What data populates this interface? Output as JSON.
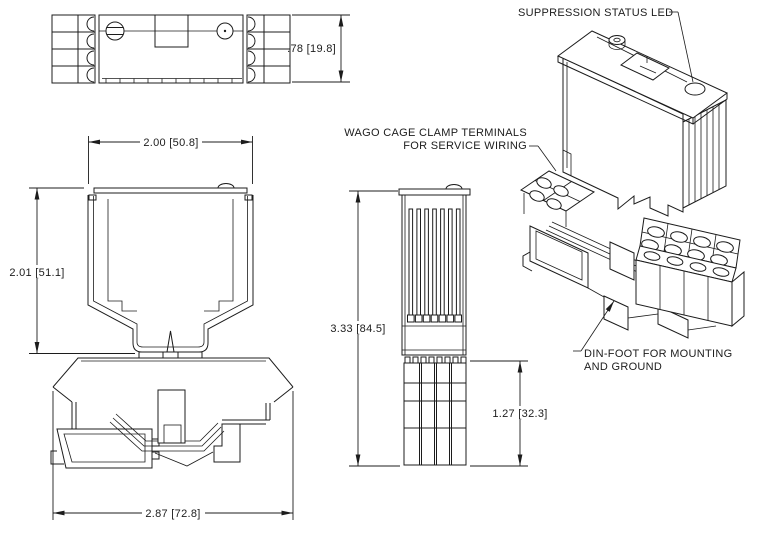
{
  "drawing": {
    "background": "#ffffff",
    "line_color": "#1c1c1c",
    "type": "engineering-drawing"
  },
  "annotations": {
    "led": "SUPPRESSION STATUS LED",
    "wago1": "WAGO CAGE CLAMP TERMINALS",
    "wago2": "FOR SERVICE WIRING",
    "din1": "DIN-FOOT FOR MOUNTING",
    "din2": "AND GROUND"
  },
  "dimensions": {
    "top_depth": ".78 [19.8]",
    "width": "2.00 [50.8]",
    "height": "2.01 [51.1]",
    "overall_height": "3.33 [84.5]",
    "terminal_height": "1.27 [32.3]",
    "base_width": "2.87 [72.8]"
  }
}
